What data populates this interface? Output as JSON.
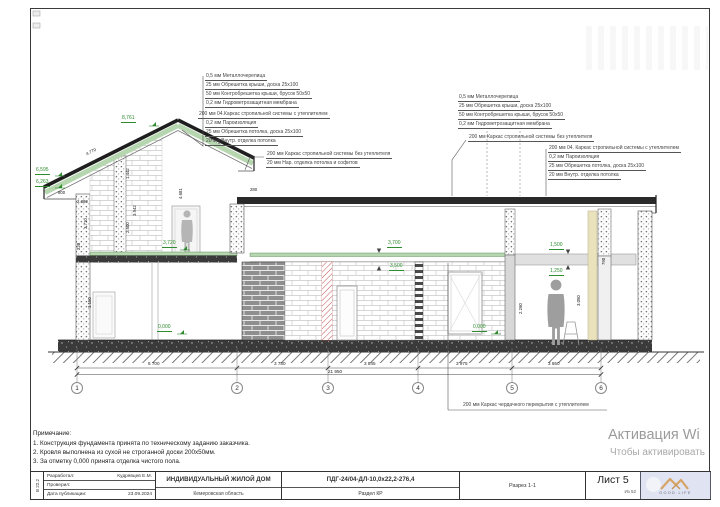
{
  "callouts": {
    "left_roof": [
      "0,5 мм  Металлочерепица",
      "25 мм  Обрешетка крыши, доска 25х100",
      "50 мм  Контробрешетка крыши, брусок 50х50",
      "0,2 мм  Гидроветрозащитная мембрана",
      "200 мм  04.Каркас стропильной системы с утеплителем",
      "0,2 мм  Пароизоляция",
      "25 мм  Обрешетка потолка, доска 25х100",
      "20 мм  Внутр. отделка потолка"
    ],
    "right_roof": [
      "0,5 мм  Металлочерепица",
      "25 мм  Обрешетка крыши, доска 25х100",
      "50 мм  Контробрешетка крыши, брусок 50х50",
      "0,2 мм  Гидроветрозащитная мембрана"
    ],
    "cold_rafter": "200 мм  Каркас стропильной системы без утеплителя",
    "right_ceiling": [
      "200 мм  04. Каркас стропильной системы с утеплителем",
      "0,2 мм  Пароизоляция",
      "25 мм  Обрешетка потолка, доска 25х100",
      "20 мм  Внутр. отделка потолка"
    ],
    "left_eaves": [
      "200 мм  Каркас стропильной системы без утеплителя",
      "20 мм  Нар. отделка потолка и софитов"
    ],
    "attic_floor": "200 мм  Каркас чердачного перекрытия с утеплителем"
  },
  "levels": {
    "ridge": "8,761",
    "eave_high": "6,595",
    "eave_low": "6,263",
    "loft": "3,720",
    "ceiling_top": "3,700",
    "ceiling_bot": "3,500",
    "beam_top": "1,500",
    "beam_bot": "1,250",
    "zero_left": "0,000",
    "zero_right": "0,000"
  },
  "dims": {
    "slope_left": "4.770",
    "slope_right": "4.770",
    "w800": "800",
    "w2380": "2.380",
    "h1442": "1.442",
    "h3942": "3.942",
    "h4681": "4.681",
    "h2500": "2.500",
    "h3710": "3.710",
    "h220": "220",
    "h3150": "3.150",
    "w280": "280",
    "h2260": "2.260",
    "h3050": "3.050",
    "h790": "790"
  },
  "axes": {
    "numbers": [
      "1",
      "2",
      "3",
      "4",
      "5",
      "6"
    ],
    "segments": [
      "6 700",
      "3 780",
      "3 845",
      "3 975",
      "3 650"
    ],
    "total": "21 950"
  },
  "notes": {
    "title": "Примечание:",
    "items": [
      "1. Конструкция фундамента принята по техническому заданию заказчика.",
      "2. Кровля выполнена из сухой не строганной доски 200х50мм.",
      "3. За отметку 0,000 принята отделка чистого пола."
    ]
  },
  "titleblock": {
    "side": "В 22.2",
    "developed_label": "Разработал:",
    "developed_by": "Кудрявцев Е.М.",
    "checked_label": "Проверил:",
    "date_label": "Дата публикации:",
    "date": "23.09.2024",
    "project": "ИНДИВИДУАЛЬНЫЙ ЖИЛОЙ ДОМ",
    "location": "Кемеровская область",
    "doc_code": "ПДГ-24/04-ДЛ-10,0х22,2-276,4",
    "doc_section": "Раздел КР",
    "view_name": "Разрез 1-1",
    "sheet": "Лист 5",
    "sheet_total": "Из 52",
    "logo": "GOOD LIFE"
  },
  "watermark": {
    "line1": "Активация Wi",
    "line2": "Чтобы активировать"
  },
  "colors": {
    "level_green": "#2e8b2e",
    "roof_insulation_green": "#b5d6ae",
    "red_hatch": "#c25050",
    "logo_orange": "#f0a030"
  }
}
